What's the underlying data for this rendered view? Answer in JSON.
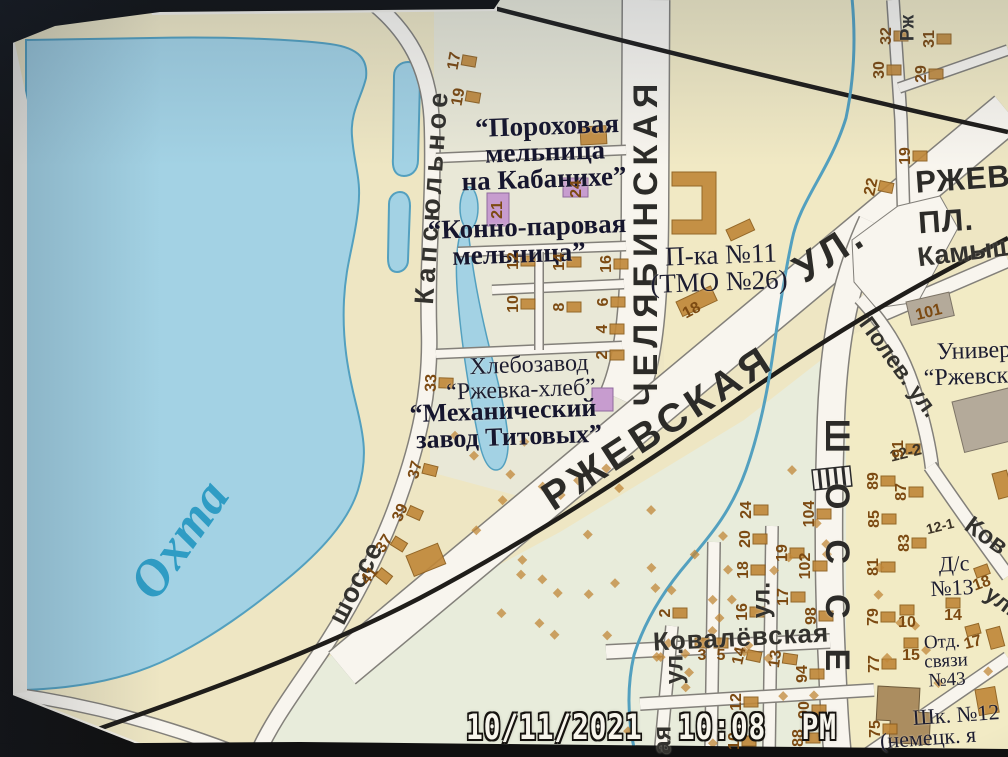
{
  "photo": {
    "timestamp": "10/11/2021  10:08  PM"
  },
  "colors": {
    "water": "#a3d2e4",
    "wedge": "#53a0bf",
    "rd": "#f8f5ee",
    "rdedge": "#83807a",
    "rail": "#1f1d1a",
    "bldg": "#c08738",
    "bldgedge": "#8a5a18",
    "purple": "#c79ccf",
    "numcol": "#7c4a12",
    "rivertext": "#2f9cc4",
    "paper": "#eee6c3"
  },
  "map": {
    "labels": [
      {
        "t": "ЧЕЛЯБИНСКАЯ",
        "x": 646,
        "y": 242,
        "r": -90,
        "c": "sb",
        "s": 34,
        "ls": 6
      },
      {
        "t": "РЖЕВСКАЯ",
        "x": 658,
        "y": 428,
        "r": -33,
        "c": "sb",
        "s": 40,
        "ls": 5
      },
      {
        "t": "УЛ.",
        "x": 830,
        "y": 252,
        "r": -33,
        "c": "sb",
        "s": 40,
        "ls": 5
      },
      {
        "t": "ШОССЕ",
        "x": 837,
        "y": 560,
        "r": 90,
        "c": "sb",
        "s": 34,
        "ls": 30
      },
      {
        "t": "РЖЕВ",
        "x": 963,
        "y": 179,
        "r": -4,
        "c": "sb",
        "s": 31,
        "ls": 1
      },
      {
        "t": "ПЛ.",
        "x": 946,
        "y": 221,
        "r": -4,
        "c": "sb",
        "s": 31,
        "ls": 1
      },
      {
        "t": "Камыш",
        "x": 966,
        "y": 252,
        "r": -7,
        "c": "sm",
        "s": 27
      },
      {
        "t": "Полев. ул.",
        "x": 899,
        "y": 367,
        "r": 54,
        "c": "sm",
        "s": 23
      },
      {
        "t": "Капсюльное",
        "x": 432,
        "y": 196,
        "r": -86,
        "c": "sm",
        "s": 27,
        "ls": 5
      },
      {
        "t": "шоссе",
        "x": 356,
        "y": 583,
        "r": -63,
        "c": "sm",
        "s": 27,
        "ls": 1
      },
      {
        "t": "Ковалёвская",
        "x": 741,
        "y": 637,
        "r": -3,
        "c": "sm",
        "s": 26,
        "ls": 1
      },
      {
        "t": "ул.",
        "x": 762,
        "y": 600,
        "r": -90,
        "c": "sm",
        "s": 25
      },
      {
        "t": "ул.",
        "x": 675,
        "y": 666,
        "r": -90,
        "c": "sm",
        "s": 25
      },
      {
        "t": "ая",
        "x": 663,
        "y": 740,
        "r": -90,
        "c": "sm",
        "s": 25
      },
      {
        "t": "Ков",
        "x": 986,
        "y": 536,
        "r": 36,
        "c": "sm",
        "s": 25
      },
      {
        "t": "ул.",
        "x": 1001,
        "y": 601,
        "r": 36,
        "c": "sm",
        "s": 23
      },
      {
        "t": "Рж",
        "x": 908,
        "y": 28,
        "r": -90,
        "c": "sm",
        "s": 19
      },
      {
        "t": "Охта",
        "x": 180,
        "y": 540,
        "r": -55,
        "c": "rv",
        "s": 52
      },
      {
        "t": "“Пороховая",
        "x": 547,
        "y": 126,
        "r": -2,
        "c": "ab",
        "s": 27
      },
      {
        "t": "мельница",
        "x": 545,
        "y": 152,
        "r": -2,
        "c": "ab",
        "s": 27
      },
      {
        "t": "на Кабанихе”",
        "x": 544,
        "y": 179,
        "r": -2,
        "c": "ab",
        "s": 27
      },
      {
        "t": "“Конно-паровая",
        "x": 527,
        "y": 227,
        "r": -2,
        "c": "ab",
        "s": 27
      },
      {
        "t": "мельница”",
        "x": 519,
        "y": 254,
        "r": -2,
        "c": "ab",
        "s": 27
      },
      {
        "t": "Хлебозавод",
        "x": 529,
        "y": 365,
        "r": -2,
        "c": "an",
        "s": 24
      },
      {
        "t": "“Ржевка-хлеб”",
        "x": 521,
        "y": 390,
        "r": -2,
        "c": "an",
        "s": 24
      },
      {
        "t": "“Механический",
        "x": 503,
        "y": 411,
        "r": -2,
        "c": "ab",
        "s": 26
      },
      {
        "t": "завод Титовых”",
        "x": 509,
        "y": 437,
        "r": -2,
        "c": "ab",
        "s": 26
      },
      {
        "t": "П-ка №11",
        "x": 721,
        "y": 255,
        "r": -2,
        "c": "an",
        "s": 27
      },
      {
        "t": "(ТМО №26)",
        "x": 719,
        "y": 282,
        "r": -2,
        "c": "an",
        "s": 27
      },
      {
        "t": "Универ",
        "x": 974,
        "y": 351,
        "r": -2,
        "c": "an",
        "s": 24
      },
      {
        "t": "“Ржевск",
        "x": 966,
        "y": 377,
        "r": -2,
        "c": "an",
        "s": 24
      },
      {
        "t": "Д/с",
        "x": 954,
        "y": 564,
        "r": -3,
        "c": "an",
        "s": 22
      },
      {
        "t": "№13",
        "x": 952,
        "y": 588,
        "r": -3,
        "c": "an",
        "s": 22
      },
      {
        "t": "Отд.",
        "x": 942,
        "y": 642,
        "r": -3,
        "c": "an",
        "s": 19
      },
      {
        "t": "связи",
        "x": 946,
        "y": 661,
        "r": -3,
        "c": "an",
        "s": 19
      },
      {
        "t": "№43",
        "x": 947,
        "y": 680,
        "r": -3,
        "c": "an",
        "s": 19
      },
      {
        "t": "Шк. №12",
        "x": 956,
        "y": 715,
        "r": -4,
        "c": "an",
        "s": 22
      },
      {
        "t": "(немецк. я",
        "x": 928,
        "y": 738,
        "r": -4,
        "c": "an",
        "s": 22
      },
      {
        "t": "12-2",
        "x": 906,
        "y": 454,
        "r": -14,
        "c": "dk",
        "s": 16
      },
      {
        "t": "12-1",
        "x": 940,
        "y": 526,
        "r": -14,
        "c": "dk",
        "s": 14
      }
    ],
    "house_numbers": [
      {
        "t": "17",
        "x": 455,
        "y": 61,
        "r": -80
      },
      {
        "t": "19",
        "x": 459,
        "y": 97,
        "r": -80
      },
      {
        "t": "21",
        "x": 498,
        "y": 210,
        "r": -90,
        "nb": 1
      },
      {
        "t": "24",
        "x": 577,
        "y": 189,
        "r": -90,
        "nb": 1
      },
      {
        "t": "12",
        "x": 514,
        "y": 261,
        "r": -90
      },
      {
        "t": "14",
        "x": 560,
        "y": 262,
        "r": -90
      },
      {
        "t": "16",
        "x": 607,
        "y": 264,
        "r": -90
      },
      {
        "t": "10",
        "x": 514,
        "y": 304,
        "r": -90
      },
      {
        "t": "8",
        "x": 560,
        "y": 307,
        "r": -90
      },
      {
        "t": "6",
        "x": 604,
        "y": 302,
        "r": -90
      },
      {
        "t": "4",
        "x": 603,
        "y": 329,
        "r": -90
      },
      {
        "t": "2",
        "x": 603,
        "y": 355,
        "r": -90
      },
      {
        "t": "18",
        "x": 692,
        "y": 311,
        "r": -28,
        "nb": 1
      },
      {
        "t": "33",
        "x": 432,
        "y": 383,
        "r": -88
      },
      {
        "t": "37",
        "x": 416,
        "y": 470,
        "r": -76
      },
      {
        "t": "39",
        "x": 401,
        "y": 513,
        "r": -66
      },
      {
        "t": "37",
        "x": 385,
        "y": 544,
        "r": -58
      },
      {
        "t": "41",
        "x": 370,
        "y": 576,
        "r": -52
      },
      {
        "t": "22",
        "x": 872,
        "y": 187,
        "r": -78
      },
      {
        "t": "19",
        "x": 906,
        "y": 156,
        "r": -90
      },
      {
        "t": "32",
        "x": 887,
        "y": 36,
        "r": -90
      },
      {
        "t": "30",
        "x": 880,
        "y": 70,
        "r": -90
      },
      {
        "t": "31",
        "x": 930,
        "y": 39,
        "r": -90
      },
      {
        "t": "29",
        "x": 922,
        "y": 74,
        "r": -90
      },
      {
        "t": "101",
        "x": 929,
        "y": 313,
        "r": -14,
        "nb": 1
      },
      {
        "t": "91",
        "x": 899,
        "y": 449,
        "r": -90
      },
      {
        "t": "89",
        "x": 874,
        "y": 481,
        "r": -90
      },
      {
        "t": "87",
        "x": 902,
        "y": 492,
        "r": -90
      },
      {
        "t": "85",
        "x": 875,
        "y": 519,
        "r": -90
      },
      {
        "t": "83",
        "x": 905,
        "y": 543,
        "r": -90
      },
      {
        "t": "81",
        "x": 874,
        "y": 567,
        "r": -90
      },
      {
        "t": "79",
        "x": 874,
        "y": 617,
        "r": -90
      },
      {
        "t": "77",
        "x": 875,
        "y": 664,
        "r": -90
      },
      {
        "t": "75",
        "x": 876,
        "y": 729,
        "r": -90
      },
      {
        "t": "104",
        "x": 810,
        "y": 514,
        "r": -90
      },
      {
        "t": "102",
        "x": 806,
        "y": 566,
        "r": -90
      },
      {
        "t": "98",
        "x": 812,
        "y": 616,
        "r": -90
      },
      {
        "t": "94",
        "x": 803,
        "y": 674,
        "r": -90
      },
      {
        "t": "90",
        "x": 805,
        "y": 710,
        "r": -90
      },
      {
        "t": "88",
        "x": 799,
        "y": 738,
        "r": -90
      },
      {
        "t": "24",
        "x": 747,
        "y": 510,
        "r": -90
      },
      {
        "t": "20",
        "x": 746,
        "y": 539,
        "r": -90
      },
      {
        "t": "18",
        "x": 744,
        "y": 570,
        "r": -90
      },
      {
        "t": "19",
        "x": 783,
        "y": 553,
        "r": -90
      },
      {
        "t": "17",
        "x": 784,
        "y": 597,
        "r": -90
      },
      {
        "t": "16",
        "x": 743,
        "y": 612,
        "r": -90
      },
      {
        "t": "14",
        "x": 740,
        "y": 656,
        "r": -78
      },
      {
        "t": "13",
        "x": 776,
        "y": 659,
        "r": -82
      },
      {
        "t": "12",
        "x": 737,
        "y": 702,
        "r": -90
      },
      {
        "t": "10",
        "x": 735,
        "y": 741,
        "r": -90
      },
      {
        "t": "2",
        "x": 666,
        "y": 613,
        "r": -90
      },
      {
        "t": "3",
        "x": 702,
        "y": 656,
        "r": 0
      },
      {
        "t": "5",
        "x": 721,
        "y": 656,
        "r": 0
      },
      {
        "t": "15",
        "x": 911,
        "y": 656,
        "r": 0
      },
      {
        "t": "10",
        "x": 907,
        "y": 623,
        "r": 0
      },
      {
        "t": "14",
        "x": 953,
        "y": 616,
        "r": 0
      },
      {
        "t": "18",
        "x": 982,
        "y": 584,
        "r": -20
      },
      {
        "t": "17",
        "x": 973,
        "y": 643,
        "r": -15
      }
    ]
  }
}
